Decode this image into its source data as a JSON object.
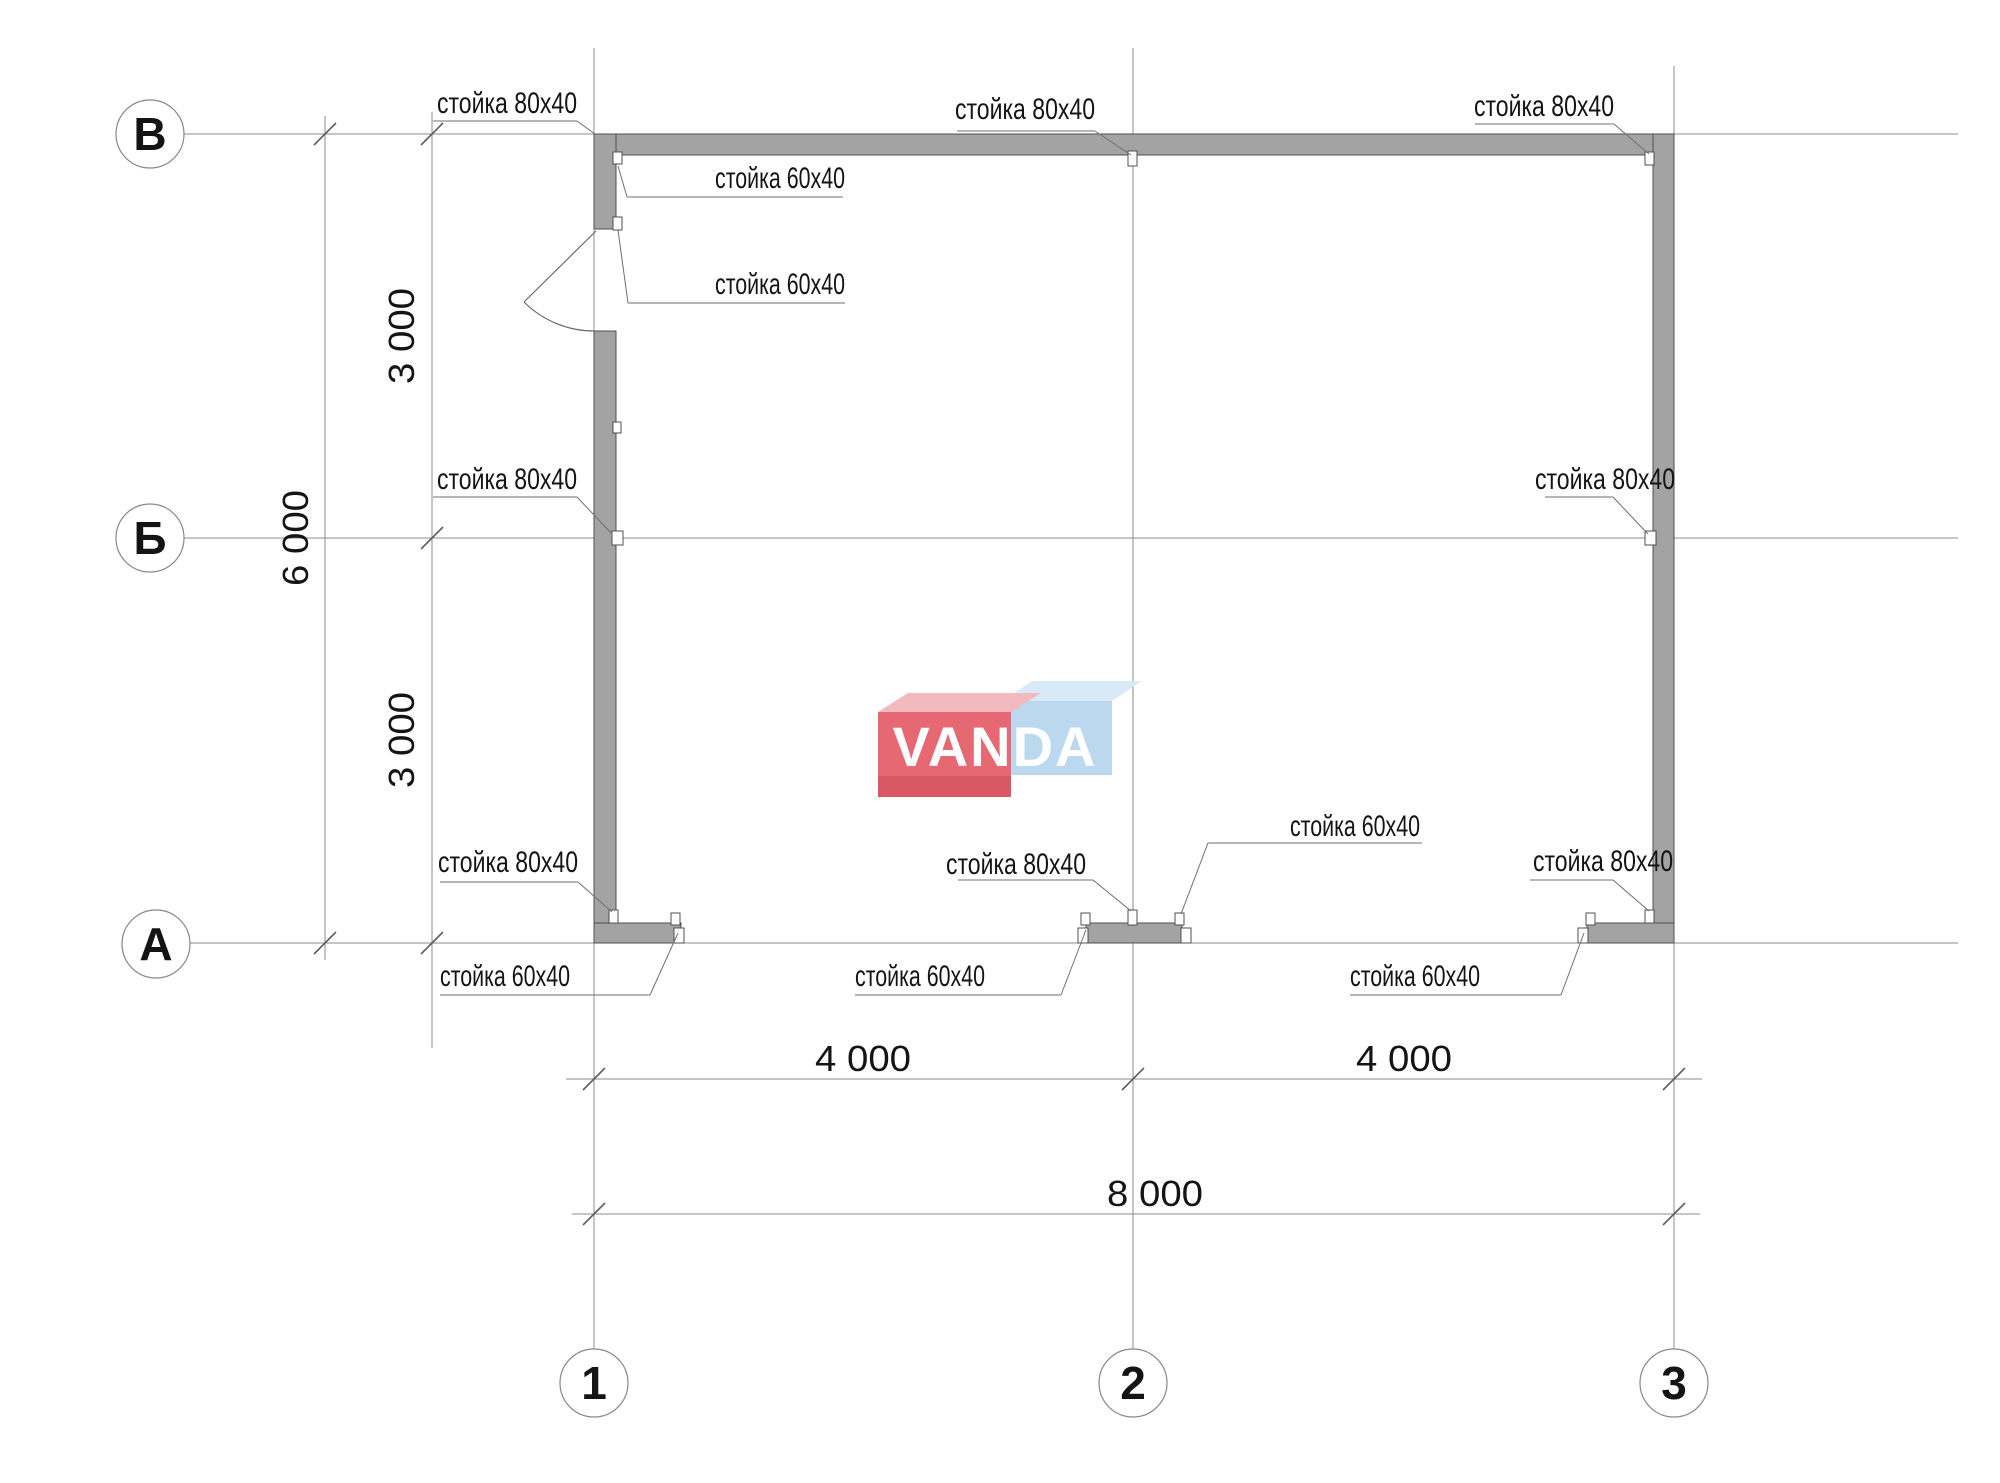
{
  "watermark": {
    "text": "VANDA",
    "red": "#e4606c",
    "red_dark": "#d7505e",
    "red_top": "#f2b6bb",
    "blue": "#b9d6ee",
    "blue_top": "#d6e9f8",
    "letter_color": "#ffffff"
  },
  "axis_bubbles": [
    {
      "label": "В",
      "cx": 150,
      "cy": 134
    },
    {
      "label": "Б",
      "cx": 150,
      "cy": 538
    },
    {
      "label": "А",
      "cx": 156,
      "cy": 944
    },
    {
      "label": "1",
      "cx": 594,
      "cy": 1383
    },
    {
      "label": "2",
      "cx": 1133,
      "cy": 1383
    },
    {
      "label": "3",
      "cx": 1674,
      "cy": 1383
    }
  ],
  "grid": {
    "vertical": [
      {
        "x": 594,
        "y1": 48,
        "y2": 1349
      },
      {
        "x": 1133,
        "y1": 48,
        "y2": 1349
      },
      {
        "x": 1674,
        "y1": 66,
        "y2": 1349
      }
    ],
    "horizontal": [
      {
        "y": 134,
        "x1": 184,
        "x2": 1958
      },
      {
        "y": 538,
        "x1": 184,
        "x2": 1958
      },
      {
        "y": 943,
        "x1": 190,
        "x2": 1958
      }
    ]
  },
  "dimensions": [
    {
      "orient": "v",
      "x": 432,
      "y1": 112,
      "y2": 1048,
      "ticks": [
        134,
        538,
        943
      ],
      "tx": 414,
      "texts": [
        {
          "v": "3 000",
          "at": 336
        },
        {
          "v": "3 000",
          "at": 740
        }
      ]
    },
    {
      "orient": "v",
      "x": 325,
      "y1": 116,
      "y2": 960,
      "ticks": [
        134,
        943
      ],
      "tx": 308,
      "texts": [
        {
          "v": "6 000",
          "at": 538
        }
      ]
    },
    {
      "orient": "h",
      "y": 1079,
      "x1": 566,
      "x2": 1702,
      "ticks": [
        594,
        1133,
        1674
      ],
      "ty": 1071,
      "texts": [
        {
          "v": "4 000",
          "at": 863
        },
        {
          "v": "4 000",
          "at": 1404
        }
      ]
    },
    {
      "orient": "h",
      "y": 1214,
      "x1": 572,
      "x2": 1700,
      "ticks": [
        594,
        1674
      ],
      "ty": 1206,
      "texts": [
        {
          "v": "8 000",
          "at": 1155
        }
      ]
    }
  ],
  "post_labels": [
    {
      "text": "стойка 80x40",
      "tx": 577,
      "ty": 113,
      "anchor": "end",
      "tl": 140,
      "u": [
        433,
        121,
        577
      ],
      "l": [
        577,
        121,
        595,
        134
      ]
    },
    {
      "text": "стойка 80x40",
      "tx": 1095,
      "ty": 119,
      "anchor": "end",
      "tl": 140,
      "u": [
        957,
        131,
        1095
      ],
      "l": [
        1095,
        131,
        1131,
        155
      ]
    },
    {
      "text": "стойка 80x40",
      "tx": 1614,
      "ty": 116,
      "anchor": "end",
      "tl": 140,
      "u": [
        1475,
        124,
        1614
      ],
      "l": [
        1614,
        124,
        1649,
        154
      ]
    },
    {
      "text": "стойка 60x40",
      "tx": 715,
      "ty": 188,
      "anchor": "start",
      "tl": 130,
      "u": [
        627,
        197,
        843
      ],
      "l": [
        627,
        197,
        618,
        166
      ]
    },
    {
      "text": "стойка 60x40",
      "tx": 715,
      "ty": 294,
      "anchor": "start",
      "tl": 130,
      "u": [
        628,
        303,
        845
      ],
      "l": [
        628,
        303,
        618,
        230
      ]
    },
    {
      "text": "стойка 80x40",
      "tx": 577,
      "ty": 489,
      "anchor": "end",
      "tl": 140,
      "u": [
        433,
        497,
        577
      ],
      "l": [
        577,
        497,
        612,
        534
      ]
    },
    {
      "text": "стойка 80x40",
      "tx": 1675,
      "ty": 489,
      "anchor": "end",
      "tl": 140,
      "u": [
        1545,
        497,
        1613
      ],
      "l": [
        1613,
        497,
        1648,
        534
      ]
    },
    {
      "text": "стойка 80x40",
      "tx": 578,
      "ty": 872,
      "anchor": "end",
      "tl": 140,
      "u": [
        440,
        882,
        578
      ],
      "l": [
        578,
        882,
        612,
        912
      ]
    },
    {
      "text": "стойка 80x40",
      "tx": 1086,
      "ty": 874,
      "anchor": "end",
      "tl": 140,
      "u": [
        958,
        880,
        1093
      ],
      "l": [
        1093,
        880,
        1131,
        911
      ]
    },
    {
      "text": "стойка 80x40",
      "tx": 1673,
      "ty": 871,
      "anchor": "end",
      "tl": 140,
      "u": [
        1530,
        880,
        1613
      ],
      "l": [
        1613,
        880,
        1649,
        911
      ]
    },
    {
      "text": "стойка 60x40",
      "tx": 1420,
      "ty": 836,
      "anchor": "end",
      "tl": 130,
      "u": [
        1208,
        843,
        1422
      ],
      "l": [
        1208,
        843,
        1181,
        914
      ]
    },
    {
      "text": "стойка 60x40",
      "tx": 440,
      "ty": 986,
      "anchor": "start",
      "tl": 130,
      "u": [
        440,
        995,
        650
      ],
      "l": [
        650,
        995,
        678,
        933
      ]
    },
    {
      "text": "стойка 60x40",
      "tx": 855,
      "ty": 986,
      "anchor": "start",
      "tl": 130,
      "u": [
        855,
        995,
        1061
      ],
      "l": [
        1061,
        995,
        1086,
        930
      ]
    },
    {
      "text": "стойка 60x40",
      "tx": 1350,
      "ty": 986,
      "anchor": "start",
      "tl": 130,
      "u": [
        1350,
        995,
        1561
      ],
      "l": [
        1561,
        995,
        1584,
        933
      ]
    }
  ]
}
